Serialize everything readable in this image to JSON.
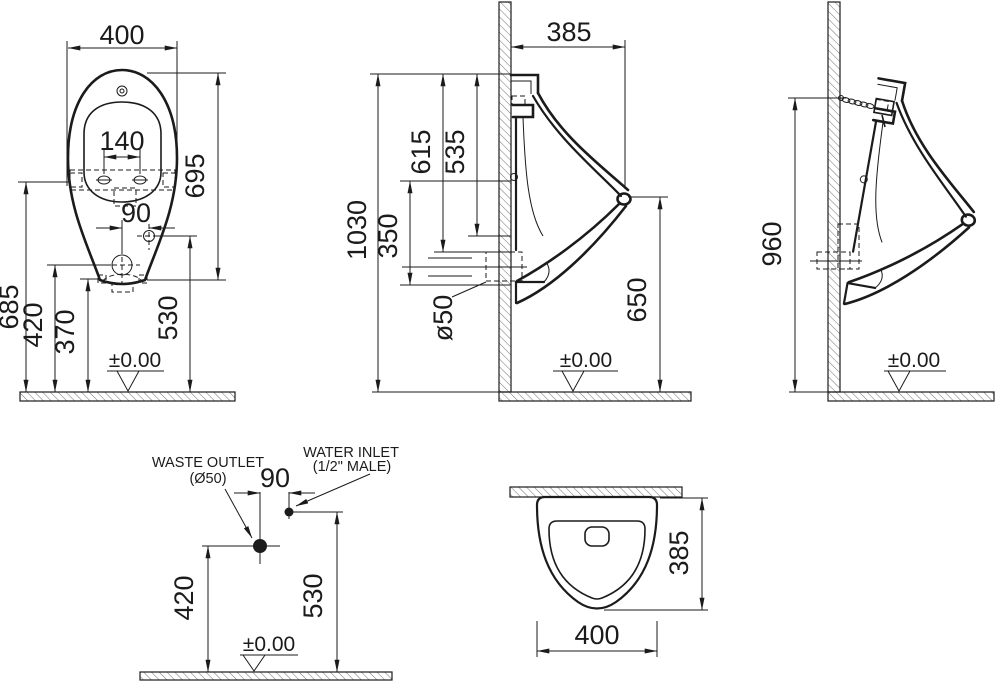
{
  "drawing": {
    "front_view": {
      "width": "400",
      "bolt_spacing": "140",
      "height": "695",
      "inlet_offset": "90",
      "fixing_height": "685",
      "outlet_height": "420",
      "rim_height": "370",
      "inlet_height": "530",
      "datum": "±0.00"
    },
    "side_view": {
      "depth": "385",
      "top_to_outlet": "615",
      "top_to_inlet": "535",
      "overall_height": "1030",
      "fixing_span": "350",
      "outlet_diameter": "ø50",
      "rim_height": "650",
      "datum": "±0.00"
    },
    "hanging_view": {
      "hanger_height": "960",
      "datum": "±0.00"
    },
    "connection_view": {
      "waste_outlet_label": "WASTE OUTLET",
      "waste_outlet_size": "(Ø50)",
      "water_inlet_label": "WATER INLET",
      "water_inlet_size": "(1/2\" MALE)",
      "spacing": "90",
      "outlet_height": "420",
      "inlet_height": "530",
      "datum": "±0.00"
    },
    "top_view": {
      "depth": "385",
      "width": "400"
    }
  }
}
